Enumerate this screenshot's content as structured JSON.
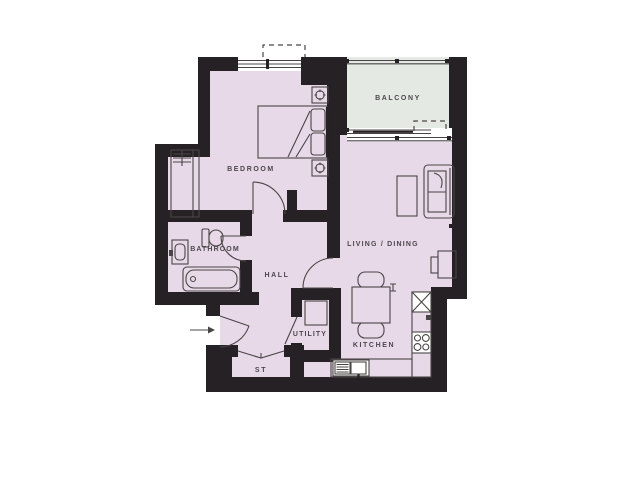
{
  "colors": {
    "background": "#ffffff",
    "wall": "#262124",
    "room_fill": "#e8d9e9",
    "balcony_fill": "#e4e9e3",
    "line": "#4a4545",
    "label": "#4c474d"
  },
  "rooms": {
    "bedroom": {
      "label": "BEDROOM"
    },
    "bathroom": {
      "label": "BATHROOM"
    },
    "hall": {
      "label": "HALL"
    },
    "storage": {
      "label": "ST"
    },
    "utility": {
      "label": "UTILITY"
    },
    "kitchen": {
      "label": "KITCHEN"
    },
    "living_dining": {
      "label": "LIVING / DINING"
    },
    "balcony": {
      "label": "BALCONY"
    }
  },
  "furniture": {
    "bedroom": [
      "double-bed",
      "bedside-table-with-lamp",
      "bedside-table-with-lamp",
      "wardrobe"
    ],
    "bathroom": [
      "toilet",
      "basin",
      "bathtub"
    ],
    "utility": [
      "washing-machine"
    ],
    "kitchen": [
      "sink-with-drainer",
      "four-ring-hob",
      "boxed-unit",
      "worktop"
    ],
    "living_dining": [
      "sofa",
      "coffee-table",
      "tv-unit",
      "dining-table",
      "dining-chair",
      "dining-chair"
    ]
  },
  "entry": {
    "symbol": "→",
    "direction": "right"
  }
}
